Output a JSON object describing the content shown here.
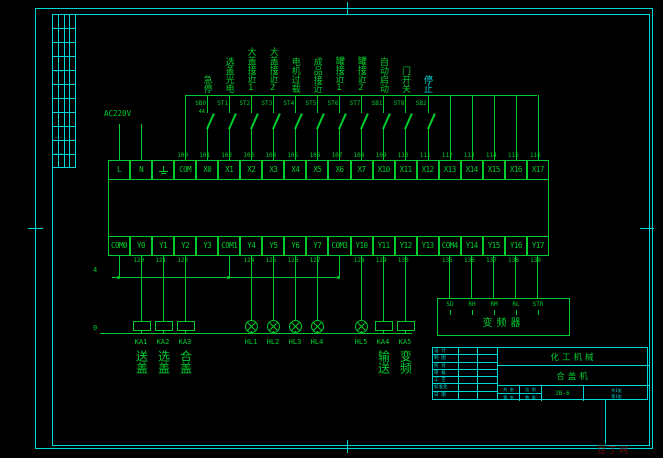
{
  "power": {
    "label": "AC220V",
    "com_bus_label": "4",
    "zero_bus_label": "0"
  },
  "inputs": {
    "columns": [
      {
        "terminal": "COM",
        "wire": "100"
      },
      {
        "wire": "101",
        "switch": "SB0",
        "sub": "4A",
        "label": "急停"
      },
      {
        "wire": "102",
        "switch": "ST1",
        "label": "选盖光电"
      },
      {
        "wire": "103",
        "switch": "ST2",
        "label": "大盖接近1"
      },
      {
        "wire": "104",
        "switch": "ST3",
        "label": "大盖接近2"
      },
      {
        "wire": "105",
        "switch": "ST4",
        "label": "电机过载"
      },
      {
        "wire": "106",
        "switch": "ST5",
        "label": "成品接近"
      },
      {
        "wire": "107",
        "switch": "ST6",
        "label": "罐接近1"
      },
      {
        "wire": "108",
        "switch": "ST7",
        "label": "罐接近2"
      },
      {
        "wire": "109",
        "switch": "SB1",
        "label": "自动启动"
      },
      {
        "wire": "110",
        "switch": "ST8",
        "label": "门开关"
      },
      {
        "wire": "111",
        "switch": "SB2",
        "label": "停止",
        "label_class": "cyan"
      },
      {
        "wire": "112"
      },
      {
        "wire": "113"
      },
      {
        "wire": "114"
      },
      {
        "wire": "115"
      },
      {
        "wire": "116"
      }
    ]
  },
  "plc": {
    "top_row": [
      {
        "label": "L"
      },
      {
        "label": "N"
      },
      {
        "label": "",
        "earth": true
      },
      {
        "label": "COM"
      },
      {
        "label": "X0"
      },
      {
        "label": "X1"
      },
      {
        "label": "X2"
      },
      {
        "label": "X3"
      },
      {
        "label": "X4"
      },
      {
        "label": "X5"
      },
      {
        "label": "X6"
      },
      {
        "label": "X7"
      },
      {
        "label": "X10"
      },
      {
        "label": "X11"
      },
      {
        "label": "X12"
      },
      {
        "label": "X13"
      },
      {
        "label": "X14"
      },
      {
        "label": "X15"
      },
      {
        "label": "X16"
      },
      {
        "label": "X17"
      }
    ],
    "bottom_row": [
      {
        "label": "COM0"
      },
      {
        "label": "Y0",
        "wire": "120"
      },
      {
        "label": "Y1",
        "wire": "121"
      },
      {
        "label": "Y2",
        "wire": "122"
      },
      {
        "label": "Y3"
      },
      {
        "label": "COM1"
      },
      {
        "label": "Y4",
        "wire": "124"
      },
      {
        "label": "Y5",
        "wire": "125"
      },
      {
        "label": "Y6",
        "wire": "126"
      },
      {
        "label": "Y7",
        "wire": "127"
      },
      {
        "label": "COM3"
      },
      {
        "label": "Y10",
        "wire": "128"
      },
      {
        "label": "Y11",
        "wire": "129"
      },
      {
        "label": "Y12",
        "wire": "130"
      },
      {
        "label": "Y13"
      },
      {
        "label": "COM4",
        "wire": "135"
      },
      {
        "label": "Y14",
        "wire": "136"
      },
      {
        "label": "Y15",
        "wire": "137"
      },
      {
        "label": "Y16",
        "wire": "138"
      },
      {
        "label": "Y17",
        "wire": "139"
      }
    ]
  },
  "devices": [
    {
      "id": "KA1",
      "caption": "送盖"
    },
    {
      "id": "KA2",
      "caption": "选盖"
    },
    {
      "id": "KA3",
      "caption": "合盖"
    },
    {
      "id": "HL1",
      "caption": ""
    },
    {
      "id": "HL2",
      "caption": ""
    },
    {
      "id": "HL3",
      "caption": ""
    },
    {
      "id": "HL4",
      "caption": ""
    },
    {
      "id": "HL5",
      "caption": ""
    },
    {
      "id": "KA4",
      "caption": "输送"
    },
    {
      "id": "KA5",
      "caption": "变频"
    }
  ],
  "vfd": {
    "title": "变频器",
    "terminals": [
      "SD",
      "RH",
      "RM",
      "RL",
      "STR"
    ]
  },
  "title_block": {
    "left_rows": [
      "设 计",
      "制 图",
      "校 对",
      "审 核",
      "工 艺",
      "标准化",
      "日 期"
    ],
    "project": "化工机械",
    "drawing": "合盖机",
    "doc_no": "2B-6",
    "cells_a": [
      "共 张",
      "第 张"
    ],
    "cells_b": [
      "比 例",
      "数 量"
    ],
    "footer_lines": [
      "共1张",
      "第1张"
    ]
  },
  "side_strip": {
    "marks": [
      "— —",
      "— —",
      "— —"
    ]
  },
  "watermark": "豆丁网"
}
